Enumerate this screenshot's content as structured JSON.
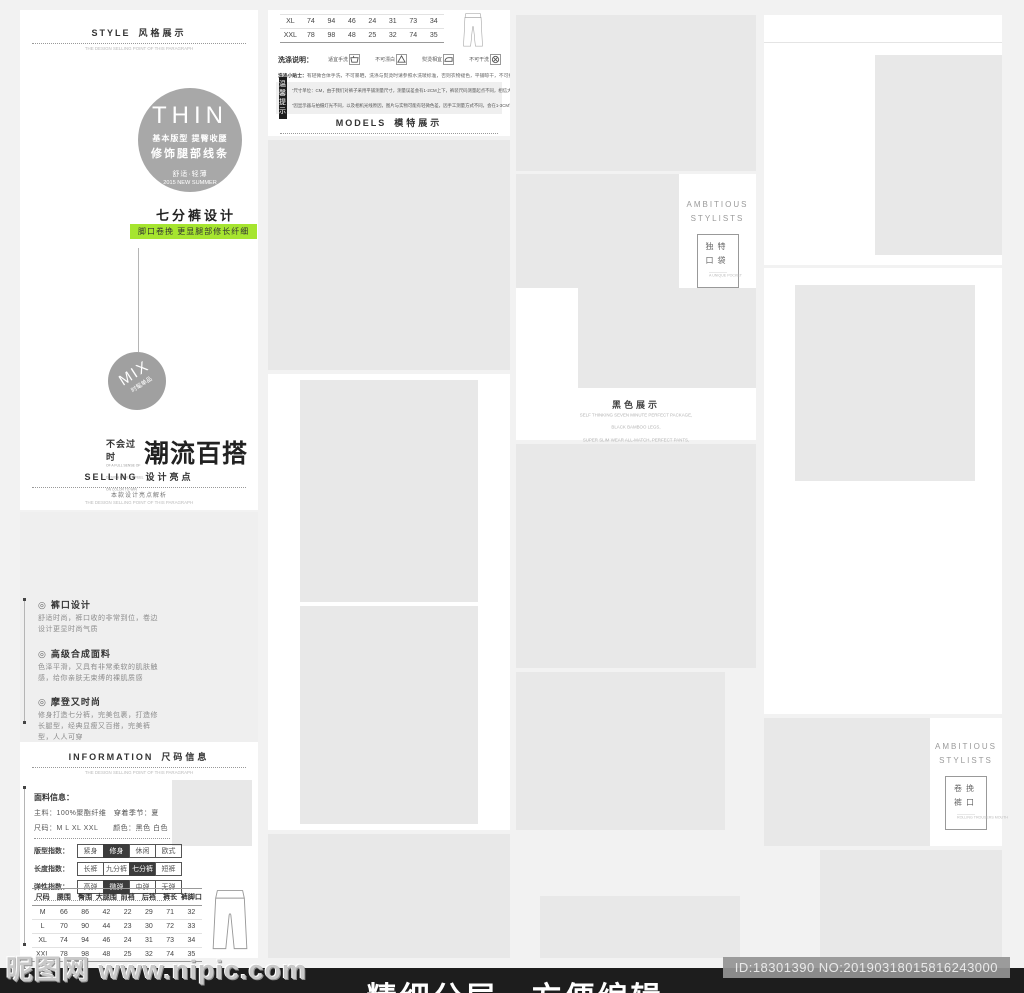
{
  "page": {
    "caption": "精细分层，方便编辑",
    "watermark": "昵图网 www.nipic.com",
    "image_id": "ID:18301390 NO:20190318015816243000"
  },
  "colors": {
    "accent_green": "#a6e52f",
    "badge_gray": "#a8a8a8",
    "bar_black": "#1d1d1d",
    "placeholder_gray": "#e8e8e8"
  },
  "style_section": {
    "header": {
      "en": "STYLE",
      "zh": "风格展示",
      "sub_en": "THE DESIGN SELLING POINT OF THIS PARAGRAPH"
    },
    "thin_badge": {
      "title": "THIN",
      "line1": "基本版型 提臀收腰",
      "line2": "修饰腿部线条",
      "line3": "舒适·轻薄",
      "line4": "2015 NEW SUMMER"
    },
    "design_title": "七分裤设计",
    "design_tag": "脚口卷挽 更显腿部修长纤细",
    "mix_badge": {
      "title": "MIX",
      "sub": "时髦单品"
    },
    "trend": {
      "zh": "不会过时",
      "en1": "OF A FULL SENSE OF",
      "en2": "DESIGN QUALITY FEEL",
      "en3": "ON COLOR TO WIN",
      "big": "潮流百搭"
    }
  },
  "selling_section": {
    "header": {
      "en": "SELLING",
      "zh": "设计亮点",
      "sub_zh": "本款设计亮点解析",
      "sub_en": "THE DESIGN SELLING POINT OF THIS PARAGRAPH"
    },
    "bullet_icon": "◎",
    "features": [
      {
        "title": "裤口设计",
        "desc": "舒适时尚，裤口收的非常到位，卷边设计更显时尚气质"
      },
      {
        "title": "高级合成面料",
        "desc": "色泽平滑，又具有非常柔软的肌肤触感，给你亲肤无束缚的裸肌质感"
      },
      {
        "title": "摩登又时尚",
        "desc": "修身打造七分裤，完美包裹，打造修长腿型，经典显瘦又百搭，完美裤型，人人可穿"
      }
    ]
  },
  "information_section": {
    "header": {
      "en": "INFORMATION",
      "zh": "尺码信息",
      "sub_en": "THE DESIGN SELLING POINT OF THIS PARAGRAPH"
    },
    "fabric": {
      "title": "面料信息：",
      "line1": "主料：100%聚酯纤维　穿着季节：夏",
      "line2": "尺码：M L XL XXL　　颜色：黑色 白色"
    },
    "indexes": [
      {
        "label": "版型指数：",
        "options": [
          "紧身",
          "修身",
          "休闲",
          "欧式"
        ],
        "selected": 1
      },
      {
        "label": "长度指数：",
        "options": [
          "长裤",
          "九分裤",
          "七分裤",
          "短裤"
        ],
        "selected": 2
      },
      {
        "label": "弹性指数：",
        "options": [
          "高弹",
          "微弹",
          "中弹",
          "无弹"
        ],
        "selected": 1
      }
    ]
  },
  "size_table": {
    "headers": [
      "尺码",
      "腰围",
      "臀围",
      "大腿围",
      "前裆",
      "后裆",
      "裤长",
      "裤脚口"
    ],
    "rows": [
      [
        "M",
        "66",
        "86",
        "42",
        "22",
        "29",
        "71",
        "32"
      ],
      [
        "L",
        "70",
        "90",
        "44",
        "23",
        "30",
        "72",
        "33"
      ],
      [
        "XL",
        "74",
        "94",
        "46",
        "24",
        "31",
        "73",
        "34"
      ],
      [
        "XXL",
        "78",
        "98",
        "48",
        "25",
        "32",
        "74",
        "35"
      ]
    ]
  },
  "wash_section": {
    "label": "洗涤说明：",
    "items": [
      {
        "text": "适宜手洗",
        "icon": "hand-wash-icon"
      },
      {
        "text": "不可漂白",
        "icon": "no-bleach-icon"
      },
      {
        "text": "熨烫相宜",
        "icon": "iron-icon"
      },
      {
        "text": "不可干洗",
        "icon": "no-dryclean-icon"
      },
      {
        "text": "洗水最高温度不超过110°C",
        "icon": "wash-temp-icon"
      }
    ],
    "tip_label": "洗涤小贴士：",
    "tip": "有轻微合体手洗，不可暴晒，洗涤与熨烫时请参照水洗唛标准，否则衣物褪色，平铺晾干，不可拧烫"
  },
  "notice_section": {
    "label1": "温馨",
    "label2": "提示",
    "line1": "“尺寸单位：CM，由于我们对裤子采用平铺测量尺寸，测量误差会有1-2CM上下，裤装尺码测量起点不同，相信大家会自参考”",
    "line2": "“因显示器与拍摄灯光不同，以及相机光线原因，图片与实物可能有轻微色差，因手工测量方式不同，会在1-3CM误差属于正常范围”"
  },
  "models_section": {
    "header": {
      "en": "MODELS",
      "zh": "模特展示",
      "sub_en": "THE DESIGN SELLING POINT OF THIS PARAGRAPH"
    }
  },
  "stylists_pocket": {
    "line1": "AMBITIOUS",
    "line2": "STYLISTS",
    "box_zh1": "独特",
    "box_zh2": "口袋",
    "box_en": "A UNIQUE POCKET"
  },
  "stylists_cuff": {
    "line1": "AMBITIOUS",
    "line2": "STYLISTS",
    "box_zh1": "卷挽",
    "box_zh2": "裤口",
    "box_en": "ROLLING TROUSERS MOUTH"
  },
  "color_section": {
    "title": "黑色展示",
    "lines": [
      "SELF THINKING SEVEN MINUTE PERFECT PACKAGE,",
      "BLACK BAMBOO LEGS,",
      "SUPER SLIM WEAR ALL-MATCH, PERFECT PANTS,",
      "EVERYONE CAN WEAR"
    ]
  }
}
